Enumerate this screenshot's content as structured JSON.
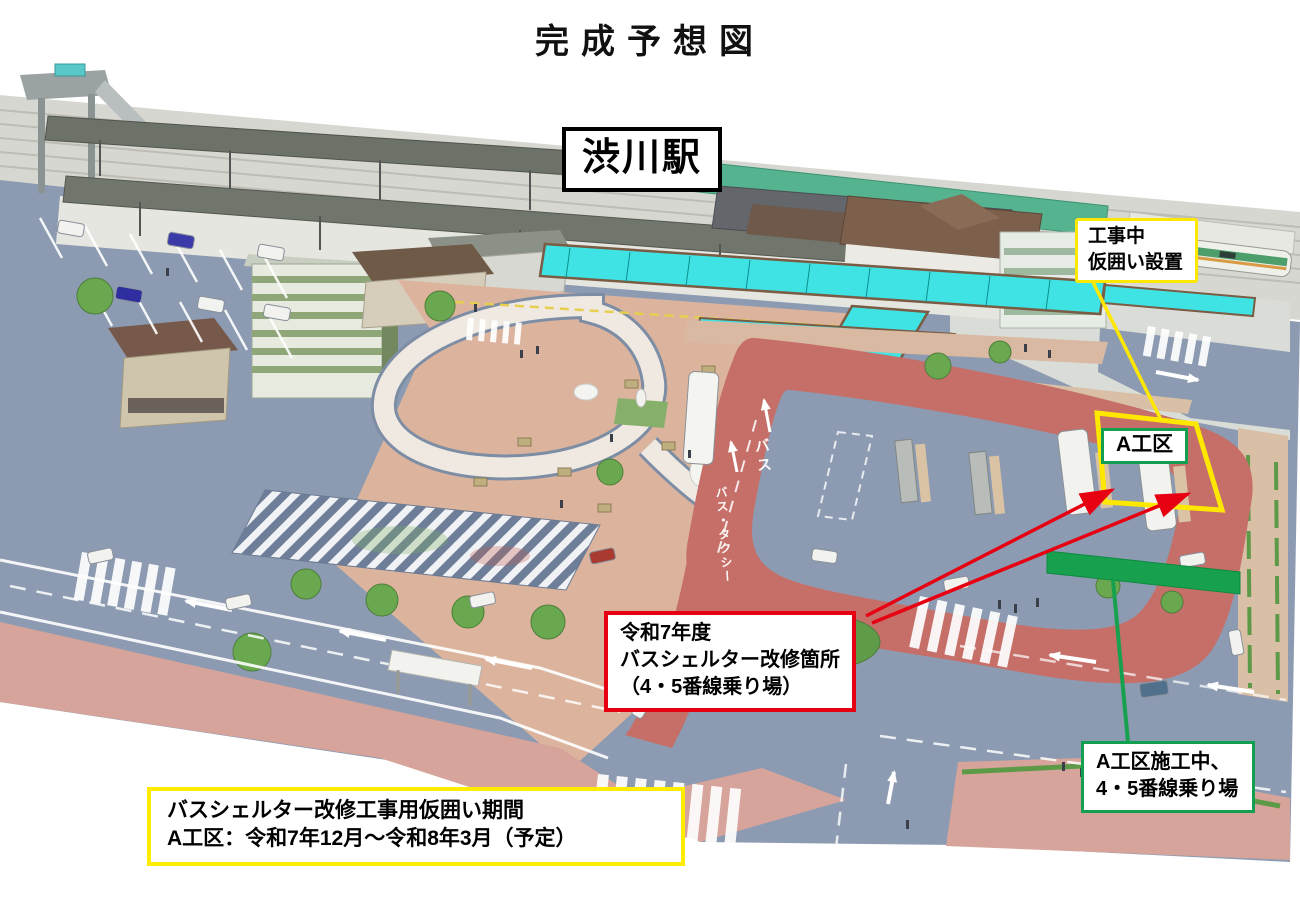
{
  "title": "完成予想図",
  "station_label": "渋川駅",
  "callouts": {
    "construction": {
      "lines": [
        "工事中",
        "仮囲い設置"
      ]
    },
    "zone": {
      "label": "A工区"
    },
    "renovation": {
      "lines": [
        "令和7年度",
        "バスシェルター改修箇所",
        "（4・5番線乗り場）"
      ]
    },
    "temp_stop": {
      "lines": [
        "A工区施工中、",
        "4・5番線乗り場"
      ]
    },
    "period": {
      "lines": [
        "バスシェルター改修工事用仮囲い期間",
        "A工区：令和7年12月～令和8年3月（予定）"
      ]
    }
  },
  "road_markings": {
    "bus_lane": "バス",
    "bus_taxi_lane": "バス・タクシー"
  },
  "colors": {
    "annotation_yellow": "#ffe800",
    "annotation_red": "#e60012",
    "annotation_green": "#12a050",
    "annotation_black": "#000000",
    "bus_loop_red": "#c66f69",
    "road_gray": "#8c9bb1",
    "plaza_pink": "#dcb49e",
    "sidewalk_pink": "#d6a49b",
    "canopy_cyan": "#3fe3e3",
    "temp_stop_green_band": "#17a14e"
  }
}
